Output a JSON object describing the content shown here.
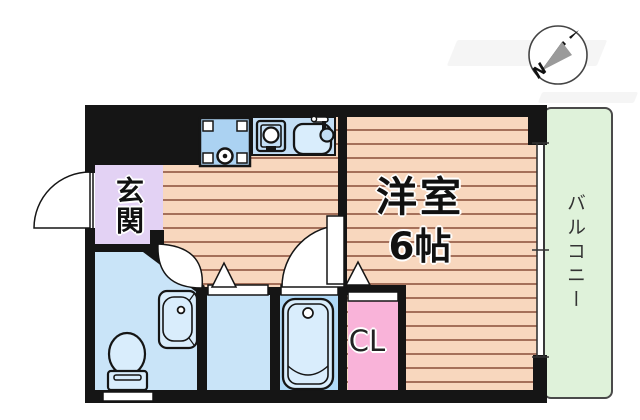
{
  "floorplan": {
    "rooms": {
      "entrance": {
        "label": "玄関"
      },
      "main_room": {
        "label": "洋室",
        "size": "6帖"
      },
      "closet": {
        "label": "CL"
      },
      "balcony": {
        "label": "バルコニー"
      }
    },
    "compass": {
      "north_label": "N"
    },
    "fixtures": [
      "washing-machine-space",
      "stove",
      "kitchen-sink",
      "washbasin",
      "toilet",
      "bathtub"
    ],
    "colors": {
      "wall": "#151515",
      "stripe_bg": "#F8D7BE",
      "stripe_line": "#A5705A",
      "genkan_fill": "#E3D2F4",
      "water_room": "#C9E4F8",
      "tub_room": "#B0D9F7",
      "fixture_fill": "#D9EDFC",
      "closet_fill": "#F9B3D9",
      "balcony_fill": "#DFF2DA",
      "counter_fill": "#C3DEF5",
      "washer_fill": "#ABD2F2"
    }
  }
}
